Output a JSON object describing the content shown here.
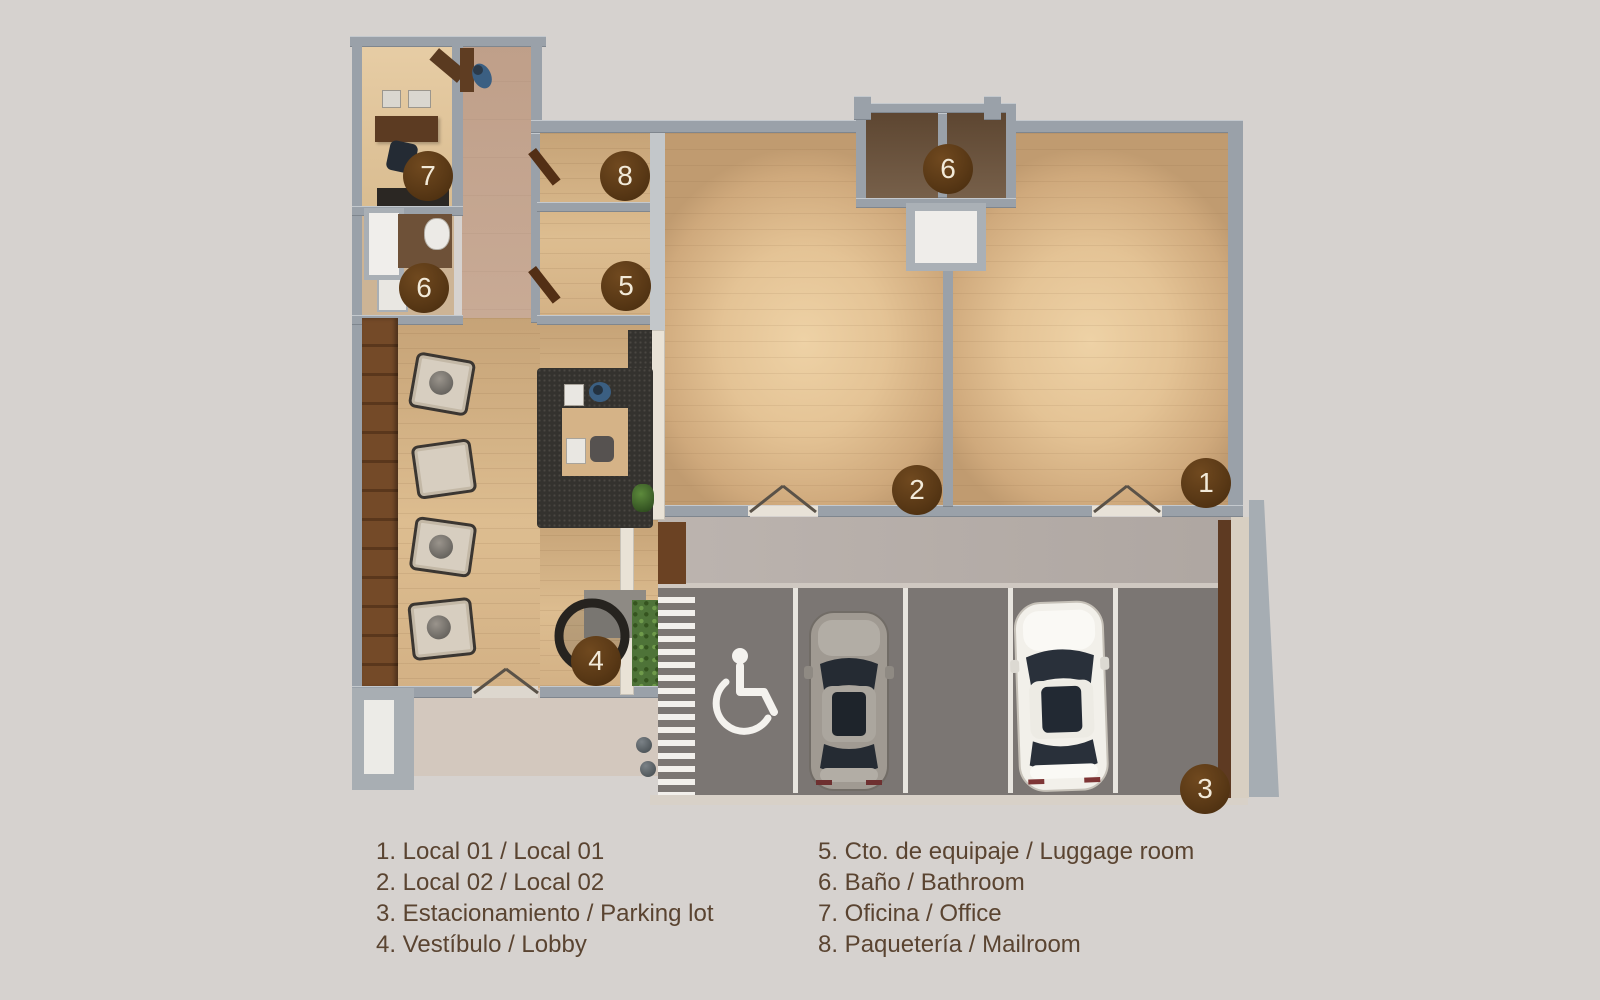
{
  "legend": {
    "column_left": [
      "1. Local 01 / Local 01",
      "2. Local 02 / Local 02",
      "3. Estacionamiento / Parking lot",
      "4. Vestíbulo / Lobby"
    ],
    "column_right": [
      "5. Cto. de equipaje / Luggage room",
      "6. Baño / Bathroom",
      "7. Oficina / Office",
      "8. Paquetería / Mailroom"
    ]
  },
  "markers": [
    {
      "number": "7"
    },
    {
      "number": "6"
    },
    {
      "number": "8"
    },
    {
      "number": "5"
    },
    {
      "number": "6"
    },
    {
      "number": "2"
    },
    {
      "number": "1"
    },
    {
      "number": "4"
    },
    {
      "number": "3"
    }
  ],
  "icons": {
    "parking_accessible": "wheelchair-symbol"
  },
  "colors": {
    "background": "#d6d2cf",
    "marker_circle": "#5a3916",
    "marker_text": "#f2ead9",
    "legend_text": "#5a4431",
    "wall_gray": "#9aa1a9",
    "wood_floor": "#ddbd90",
    "corridor_tile": "#c9ab96",
    "parking_asphalt": "#7b7673",
    "walkway": "#b2aaa5",
    "sidewalk": "#d3c8be",
    "hedge_green": "#4e7338",
    "wood_panel_wall": "#6f4426",
    "reception_desk": "#34322e",
    "car_silver": "#a09a92",
    "car_white": "#f2f0ea"
  }
}
